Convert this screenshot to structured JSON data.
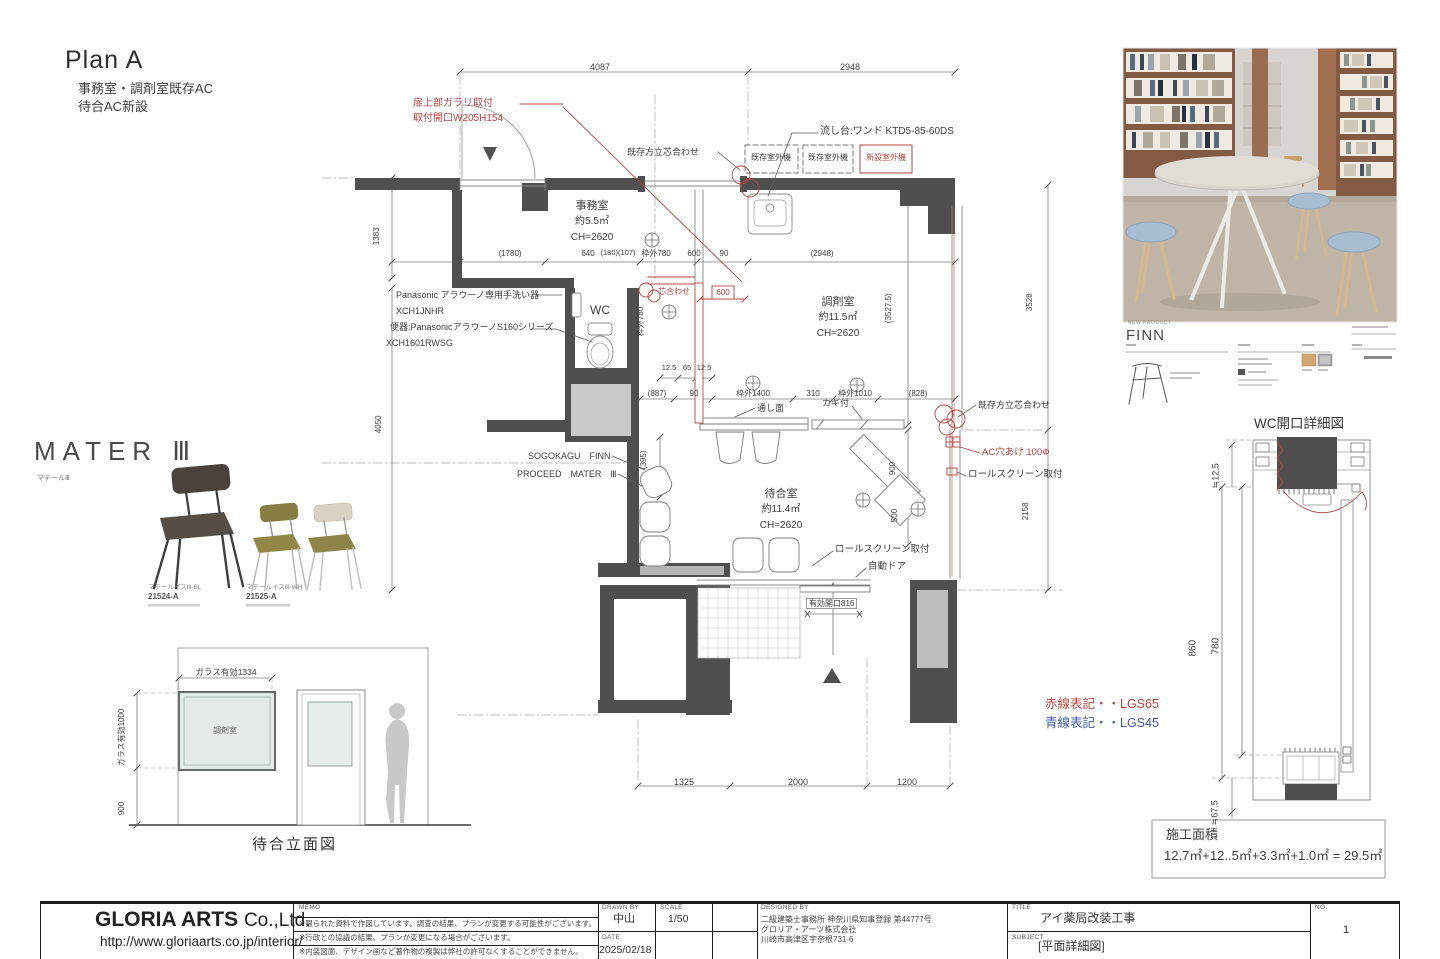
{
  "header": {
    "title": "Plan A",
    "note1": "事務室・調剤室既存AC",
    "note2": "待合AC新設"
  },
  "plan": {
    "rooms": {
      "office": {
        "name": "事務室",
        "area": "約5.5㎡",
        "ch": "CH=2620"
      },
      "dispensary": {
        "name": "調剤室",
        "area": "約11.5㎡",
        "ch": "CH=2620"
      },
      "waiting": {
        "name": "待合室",
        "area": "約11.4㎡",
        "ch": "CH=2620"
      },
      "wc": "WC"
    },
    "red": {
      "garari1": "扉上部ガラリ取付",
      "garari2": "取付開口W205H154",
      "shin": "芯合わせ",
      "box600": "600",
      "ac": "AC穴あけ 100Φ",
      "new_unit": "新設室外機"
    },
    "notes": {
      "align_top": "既存方立芯合わせ",
      "align_right": "既存方立芯合わせ",
      "sink": "流し台:ワンド KTD5-85-60DS",
      "unit1": "既存室外機",
      "unit2": "既存室外機",
      "pana1": "Panasonic アラウーノ専用手洗い器",
      "pana2": "XCH1JNHR",
      "pana3": "便器:PanasonicアラウーノS160シリーズ",
      "pana4": "XCH1601RWSG",
      "sogo": "SOGOKAGU　FINN",
      "proceed": "PROCEED　MATER　Ⅲ",
      "tooshi": "通し面",
      "kagi": "カギ付",
      "roll1": "ロールスクリーン取付",
      "roll2": "ロールスクリーン取付",
      "autodoor": "自動ドア",
      "entry": "有効開口816"
    },
    "dims": {
      "d4087": "4087",
      "d2948": "2948",
      "d1383": "1383",
      "d4050": "4050",
      "r1780": "(1780)",
      "r640": "640",
      "r180": "(180)(107)",
      "rw780": "枠外780",
      "r600": "600",
      "r90": "90",
      "r2948": "(2948)",
      "m125a": "12.5",
      "m65": "65",
      "m125b": "12.5",
      "b887": "(887)",
      "b90": "90",
      "bw1400": "枠外1400",
      "b310": "310",
      "bw1010": "枠外1010",
      "b828": "(828)",
      "v3527": "(3527.5)",
      "v3528": "3528",
      "v2158": "2158",
      "v900": "900",
      "v500": "500",
      "v395": "(395)",
      "vw780": "枠外780",
      "bot1": "1325",
      "bot2": "2000",
      "bot3": "1200"
    }
  },
  "wc_detail": {
    "title": "WC開口詳細図",
    "d1": "≒12.5",
    "d2": "860",
    "d3": "780",
    "d4": "≒67.5"
  },
  "legend": {
    "red": "赤線表記・・LGS65",
    "blue": "青線表記・・LGS45"
  },
  "area_box": {
    "label": "施工面積",
    "formula": "12.7㎡+12..5㎡+3.3㎡+1.0㎡ = 29.5㎡"
  },
  "mater": {
    "title": "MATER Ⅲ",
    "subtitle": "マテールⅢ",
    "chair1_name": "マテールイスⅢ-BL",
    "chair1_code": "21524-A",
    "chair2_name": "マテールイスⅢ-WH",
    "chair2_code": "21525-A"
  },
  "finn": {
    "tag": "NEW PRODUCT",
    "name": "FINN"
  },
  "elevation": {
    "glass_w": "ガラス有効1334",
    "glass_h": "ガラス有効1000",
    "h900": "900",
    "room": "調剤室",
    "title": "待合立面図"
  },
  "titleblock": {
    "company1": "GLORIA ARTS",
    "company2": "Co.,Ltd.",
    "url": "http://www.gloriaarts.co.jp/interior/",
    "memo_label": "MEMO",
    "memo1": "※限られた資料で作図しています。調査の結果、プランが変更する可能性がございます。",
    "memo2": "※行政との協議の結果、プランが変更になる場合がございます。",
    "memo3": "※内装図面、デザイン画など著作物の複製は弊社の許可なくすることができません。",
    "drawn_label": "DRAWN BY",
    "drawn": "中山",
    "scale_label": "SCALE",
    "scale": "1/50",
    "date_label": "DATE",
    "date": "2025/02/18",
    "designed_label": "DESIGNED BY",
    "designed1": "二級建築士事務所 神奈川県知事登録 第44777号",
    "designed2": "グロリア・アーツ株式会社",
    "designed3": "川崎市高津区宇奈根731-6",
    "title_label": "TITLE",
    "title": "アイ薬局改装工事",
    "subject_label": "SUBJECT",
    "subject": "[平面詳細図]",
    "no_label": "NO.",
    "no": "1"
  },
  "colors": {
    "red": "#b5453f",
    "blue": "#3c5ba0",
    "wall": "#4f4f4f"
  }
}
